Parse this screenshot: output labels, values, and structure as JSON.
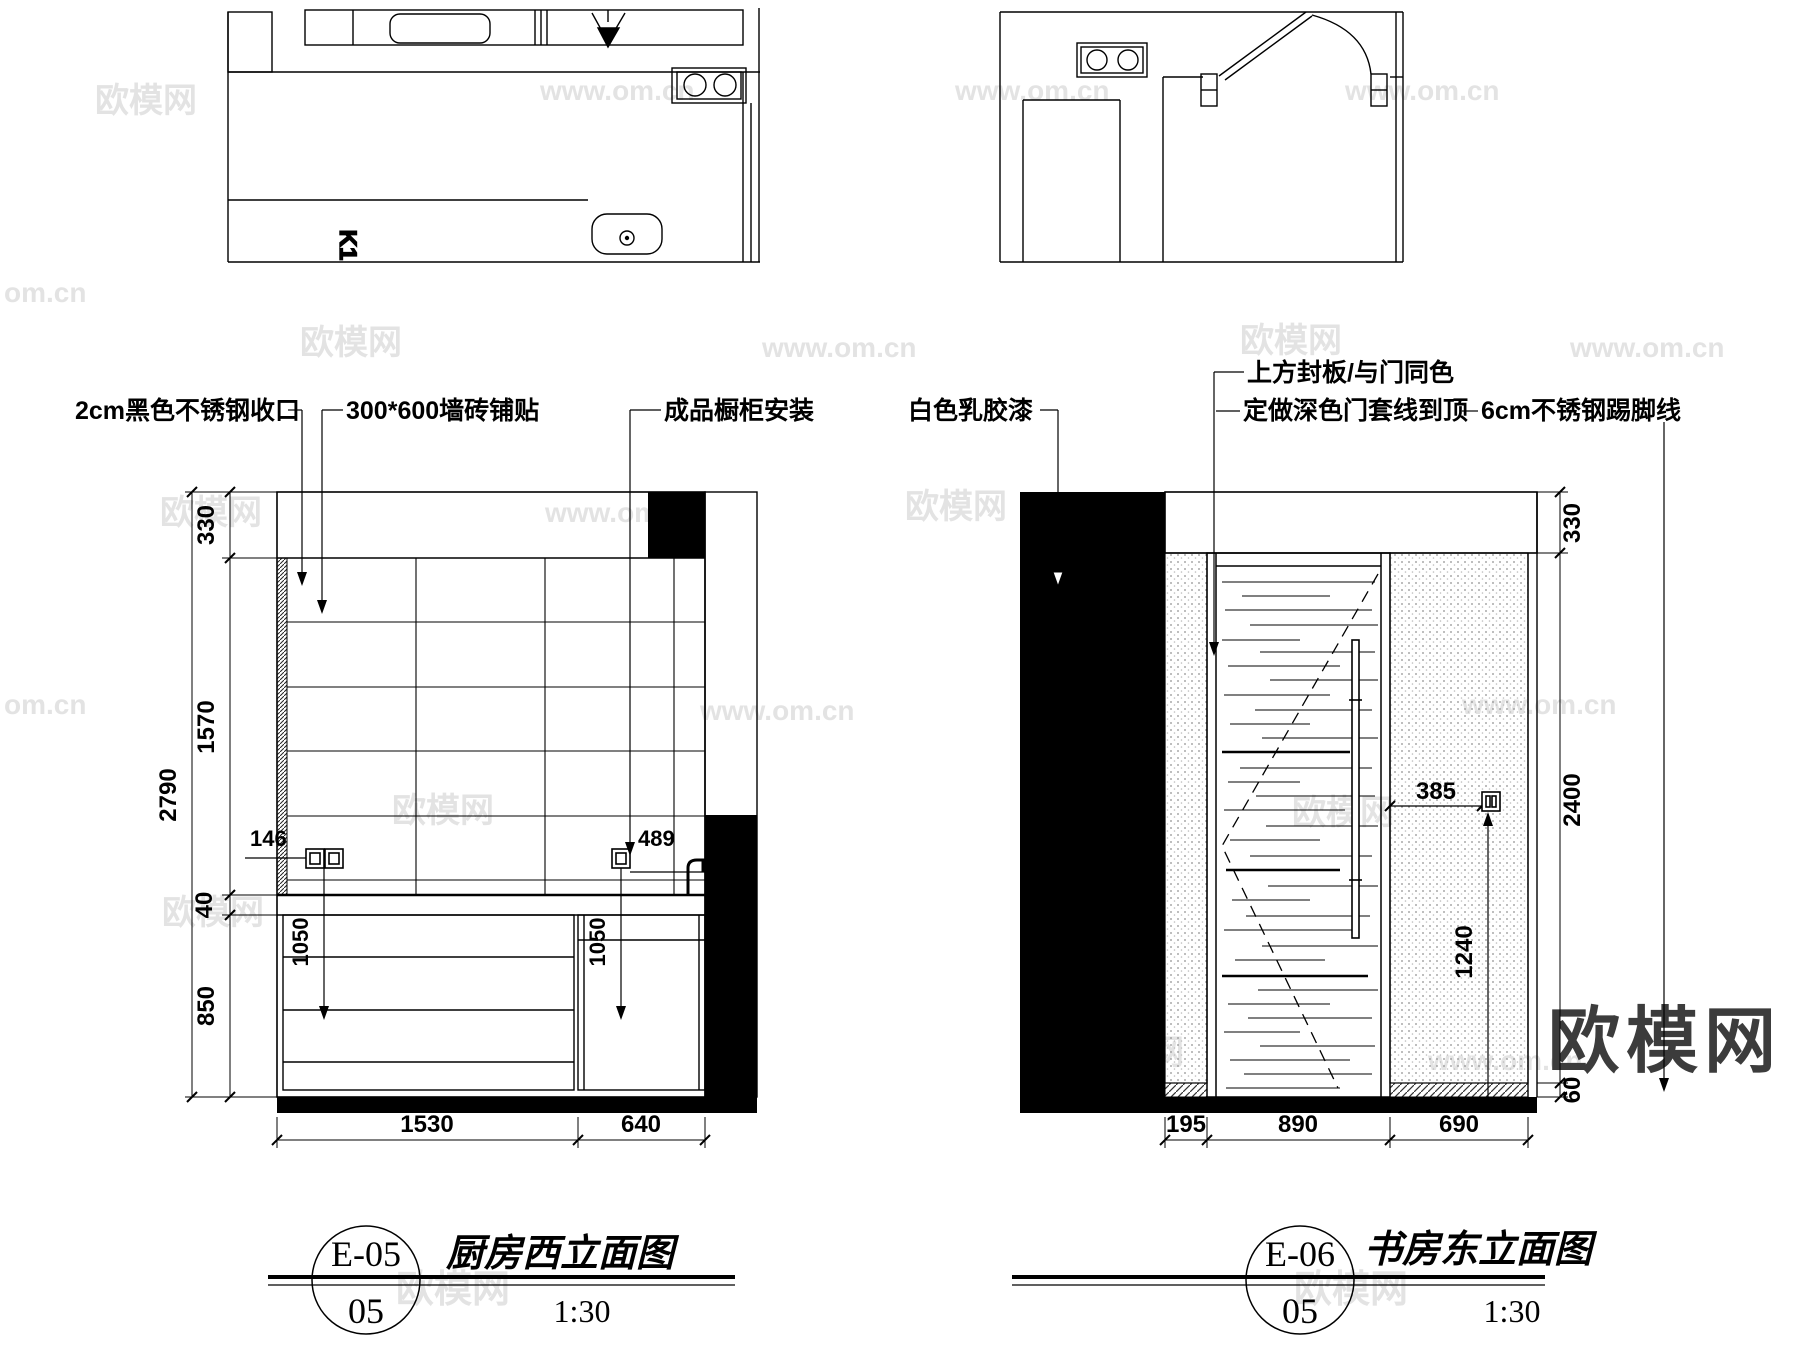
{
  "watermarks": {
    "brand": "欧模网",
    "url": "www.om.cn",
    "url_short": "om.cn"
  },
  "plan_left": {
    "label": "K1"
  },
  "elev_left": {
    "annotations": [
      "2cm黑色不锈钢收口",
      "300*600墙砖铺贴",
      "成品橱柜安装"
    ],
    "dims": {
      "total": "2790",
      "top": "330",
      "tile": "1570",
      "counter": "40",
      "base": "850",
      "socket_left": "146",
      "socket_right": "489",
      "h_left": "1050",
      "h_right": "1050",
      "bottom_left": "1530",
      "bottom_right": "640"
    },
    "title": {
      "code": "E-05",
      "sheet": "05",
      "name": "厨房西立面图",
      "scale": "1:30"
    }
  },
  "elev_right": {
    "annotations": [
      "白色乳胶漆",
      "上方封板/与门同色",
      "定做深色门套线到顶",
      "6cm不锈钢踢脚线"
    ],
    "dims": {
      "top": "330",
      "wall": "2400",
      "skirt": "60",
      "socket_offset": "385",
      "socket_height": "1240",
      "bottom": [
        "195",
        "890",
        "690"
      ]
    },
    "title": {
      "code": "E-06",
      "sheet": "05",
      "name": "书房东立面图",
      "scale": "1:30"
    }
  }
}
